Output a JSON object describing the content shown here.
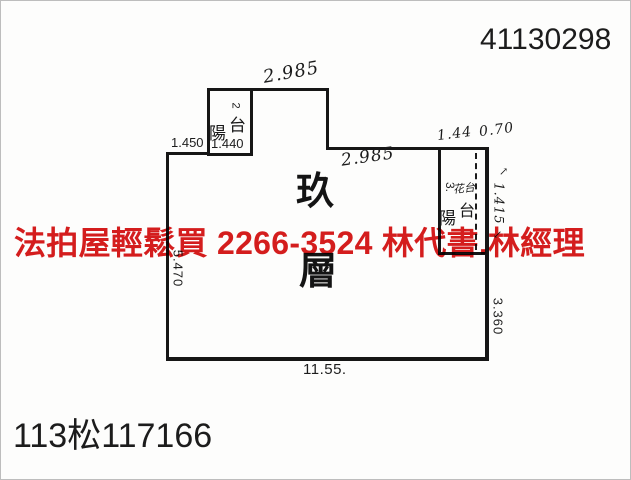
{
  "colors": {
    "ink": "#161616",
    "red": "#d61d1d",
    "paper": "#fdfdfc"
  },
  "header": {
    "serial_number": "41130298"
  },
  "footer": {
    "case_number": "113松117166"
  },
  "watermark": {
    "line": "法拍屋輕鬆買  2266-3524  林代書.林經理"
  },
  "floor_plan": {
    "floor_char_top": "玖",
    "floor_char_bottom": "層",
    "balcony_left": {
      "index": "2",
      "name_char1": "陽",
      "name_char2": "台",
      "width": "1.440"
    },
    "balcony_right": {
      "index": "3.",
      "name_char1": "陽",
      "name_char2": "台",
      "flower_box": "花台",
      "depth": "1.415"
    },
    "dims": {
      "top_width": "2.985",
      "mid_width": "2.985",
      "left_top_width": "1.450",
      "right_width_a": "1.44",
      "right_width_b": "0.70",
      "left_height": "5.470",
      "right_height": "3.360",
      "bottom_width": "11.55.",
      "arrow_up_icon": "↗",
      "arrow_down_icon": "↙"
    }
  }
}
